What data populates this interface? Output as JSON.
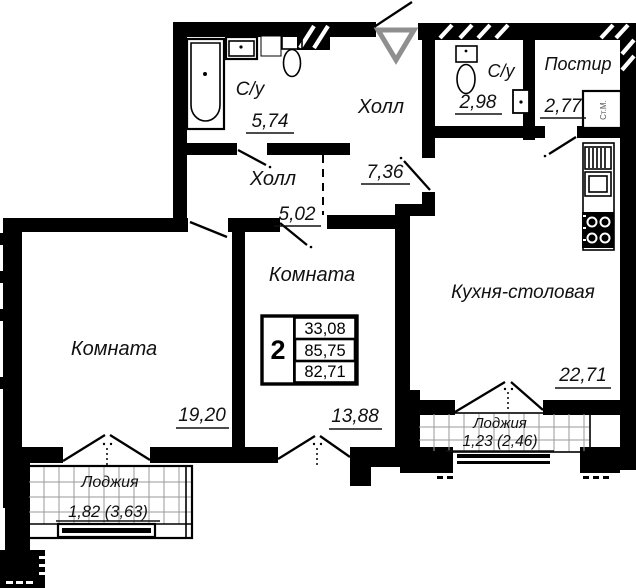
{
  "plan": {
    "rooms": {
      "bath_main": {
        "label": "С/у",
        "area": "5,74"
      },
      "hall_entry": {
        "label": "Холл",
        "area": "7,36"
      },
      "bath_guest": {
        "label": "С/у",
        "area": "2,98"
      },
      "laundry": {
        "label": "Постир",
        "area": "2,77"
      },
      "hall_inner": {
        "label": "Холл",
        "area": "5,02"
      },
      "room_left": {
        "label": "Комната",
        "area": "19,20"
      },
      "room_middle": {
        "label": "Комната",
        "area": "13,88"
      },
      "kitchen": {
        "label": "Кухня-столовая",
        "area": "22,71"
      },
      "loggia_left": {
        "label": "Лоджия",
        "area": "1,82 (3,63)"
      },
      "loggia_kitchen": {
        "label": "Лоджия",
        "area": "1,23 (2,46)"
      }
    },
    "summary": {
      "rooms_count": "2",
      "values": [
        "33,08",
        "85,75",
        "82,71"
      ]
    },
    "equipment": {
      "washing_machine_label": "Ст.М."
    },
    "colors": {
      "wall": "#000000",
      "entry_arrow": "#8f8f8f",
      "glazing_grid": "#9a9a9a"
    }
  }
}
